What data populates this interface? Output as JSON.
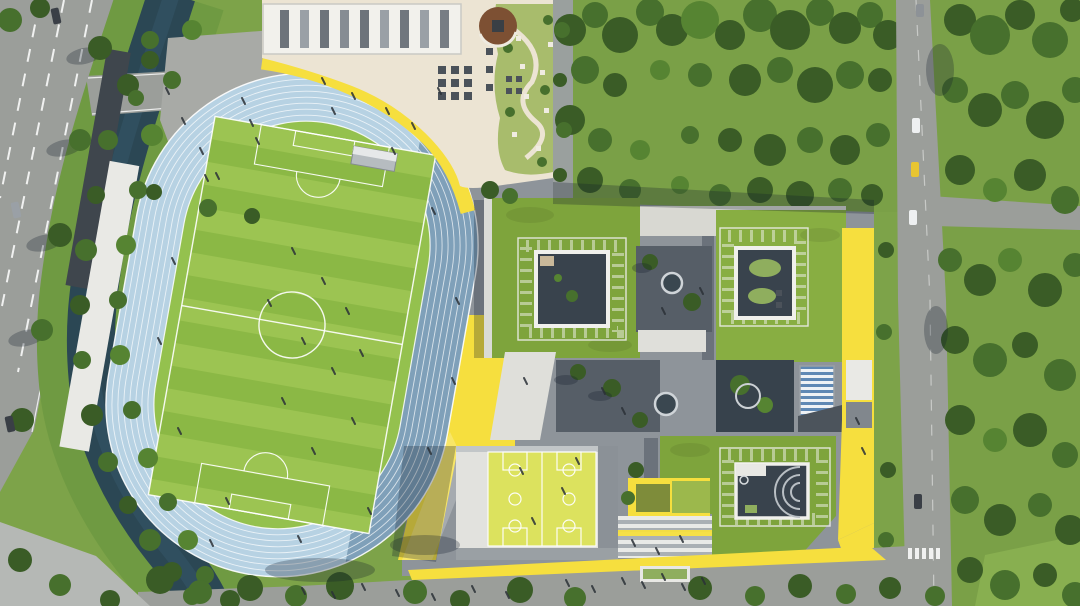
{
  "meta": {
    "type": "aerial-architectural-rendering",
    "description": "Bird's-eye 3D rendering of a school campus: oval running track with striped soccer field, grandstand, rooftop terrace garden with round wooden deck, cluster of teaching buildings with green roofs, square skylight courtyards and yellow accent facades, rooftop basketball courts, stepped striped plaza, surrounded by a canal, tree-lined roads and dense forest"
  },
  "palette": {
    "grass": "#7da349",
    "meadow": "#7aa047",
    "tree-dark": "#3a5c26",
    "tree-mid": "#47702d",
    "tree-light": "#568432",
    "water": "#2b4754",
    "bank-green": "#6f9a42",
    "road-gray": "#9b9e9a",
    "plaza-gray": "#8e949a",
    "plaza-light": "#a8aaa6",
    "track-blue": "#b7d2e3",
    "track-shadow": "#5a7e9c",
    "infield": "#94c14e",
    "field-a": "#9cc452",
    "field-b": "#8bb845",
    "white-struct": "#e9e9e5",
    "cream": "#ece4d3",
    "garden-green": "#a8bc6c",
    "wood-brown": "#7d5033",
    "accent-yellow": "#f6df3e",
    "court-yellow": "#dce25e",
    "greenroof-a": "#7ea43c",
    "greenroof-b": "#88ae42",
    "courtyard-dark": "#39434d",
    "courtyard-gray": "#565e67",
    "shrub": "#8fae5e",
    "louver-blue": "#5e88b4",
    "structure-gray": "#81878d",
    "dark-structure": "#3f464d",
    "car-dark": "#3a3f46",
    "car-white": "#eef0f1",
    "car-yellow": "#e8c531",
    "people-ink": "#2b3137",
    "shadow": "rgba(18,28,44,0.28)"
  },
  "scene": {
    "sports_zone": {
      "running_track": {
        "lanes": 8,
        "surface_color_ref": "track-blue",
        "shape": "stadium-oval",
        "tilt_deg": 10
      },
      "soccer_field": {
        "mowing_stripes": true,
        "markings": [
          "boundary",
          "center-circle",
          "center-line",
          "penalty-boxes",
          "goal-areas"
        ]
      },
      "grandstand": {
        "color_ref": "white-struct",
        "side": "west"
      },
      "equipment_shed": {
        "position": "field-north"
      }
    },
    "north_building": {
      "canopy_roof": {
        "color_ref": "white-struct",
        "ribs": 9
      },
      "rooftop_terrace": {
        "color_ref": "cream"
      },
      "round_wood_deck": {
        "color_ref": "wood-brown"
      },
      "roof_garden": {
        "color_ref": "garden-green",
        "winding_path": true
      },
      "seating_grid": {
        "rows": 3,
        "cols": 3
      },
      "yellow_edge_band": {
        "color_ref": "accent-yellow"
      }
    },
    "teaching_buildings": [
      {
        "id": "north-west",
        "roof": "green",
        "skylight_courtyard": true
      },
      {
        "id": "north-east",
        "roof": "green",
        "skylight_courtyard": true,
        "east_facade": "yellow"
      },
      {
        "id": "south-east",
        "roof": "green",
        "skylight_courtyard": true,
        "amphitheater_arcs": 3
      }
    ],
    "sports_hall": {
      "rooftop_basketball_courts": 2,
      "court_color_ref": "court-yellow"
    },
    "stepped_plaza": {
      "stripes": "white-gray",
      "yellow_band": true
    },
    "courtyards": [
      {
        "id": "between-nw-ne",
        "round_planter": true,
        "trees": 2
      },
      {
        "id": "central-west",
        "round_planter": true,
        "trees": 3
      },
      {
        "id": "central-east",
        "planting_beds": true
      },
      {
        "id": "louver-skylight",
        "stripe_color_ref": "louver-blue"
      }
    ],
    "landscape": {
      "canal": {
        "color_ref": "water",
        "banks": "planted"
      },
      "forest": {
        "position": [
          "north-east",
          "east"
        ],
        "density": "dense"
      },
      "hedge_planter": {
        "position": "south-walk"
      }
    },
    "roads": {
      "west_road": {
        "lanes": "multi",
        "markings": "dashed-white",
        "cars": 3
      },
      "east_road": {
        "cars": 5,
        "branch_east": true,
        "crosswalk": true
      },
      "south_road": {
        "street_trees": true
      }
    },
    "cars": [
      {
        "road": "west",
        "color_ref": "car-dark"
      },
      {
        "road": "west",
        "color_ref": "structure-gray"
      },
      {
        "road": "west",
        "color_ref": "car-dark"
      },
      {
        "road": "east",
        "color_ref": "car-white"
      },
      {
        "road": "east",
        "color_ref": "car-yellow"
      },
      {
        "road": "east",
        "color_ref": "car-white"
      },
      {
        "road": "east",
        "color_ref": "car-dark"
      },
      {
        "road": "east",
        "color_ref": "structure-gray"
      }
    ],
    "people": {
      "approx_count": 55,
      "areas": [
        "track",
        "field",
        "terrace",
        "plazas",
        "south-walk",
        "courts"
      ]
    }
  }
}
